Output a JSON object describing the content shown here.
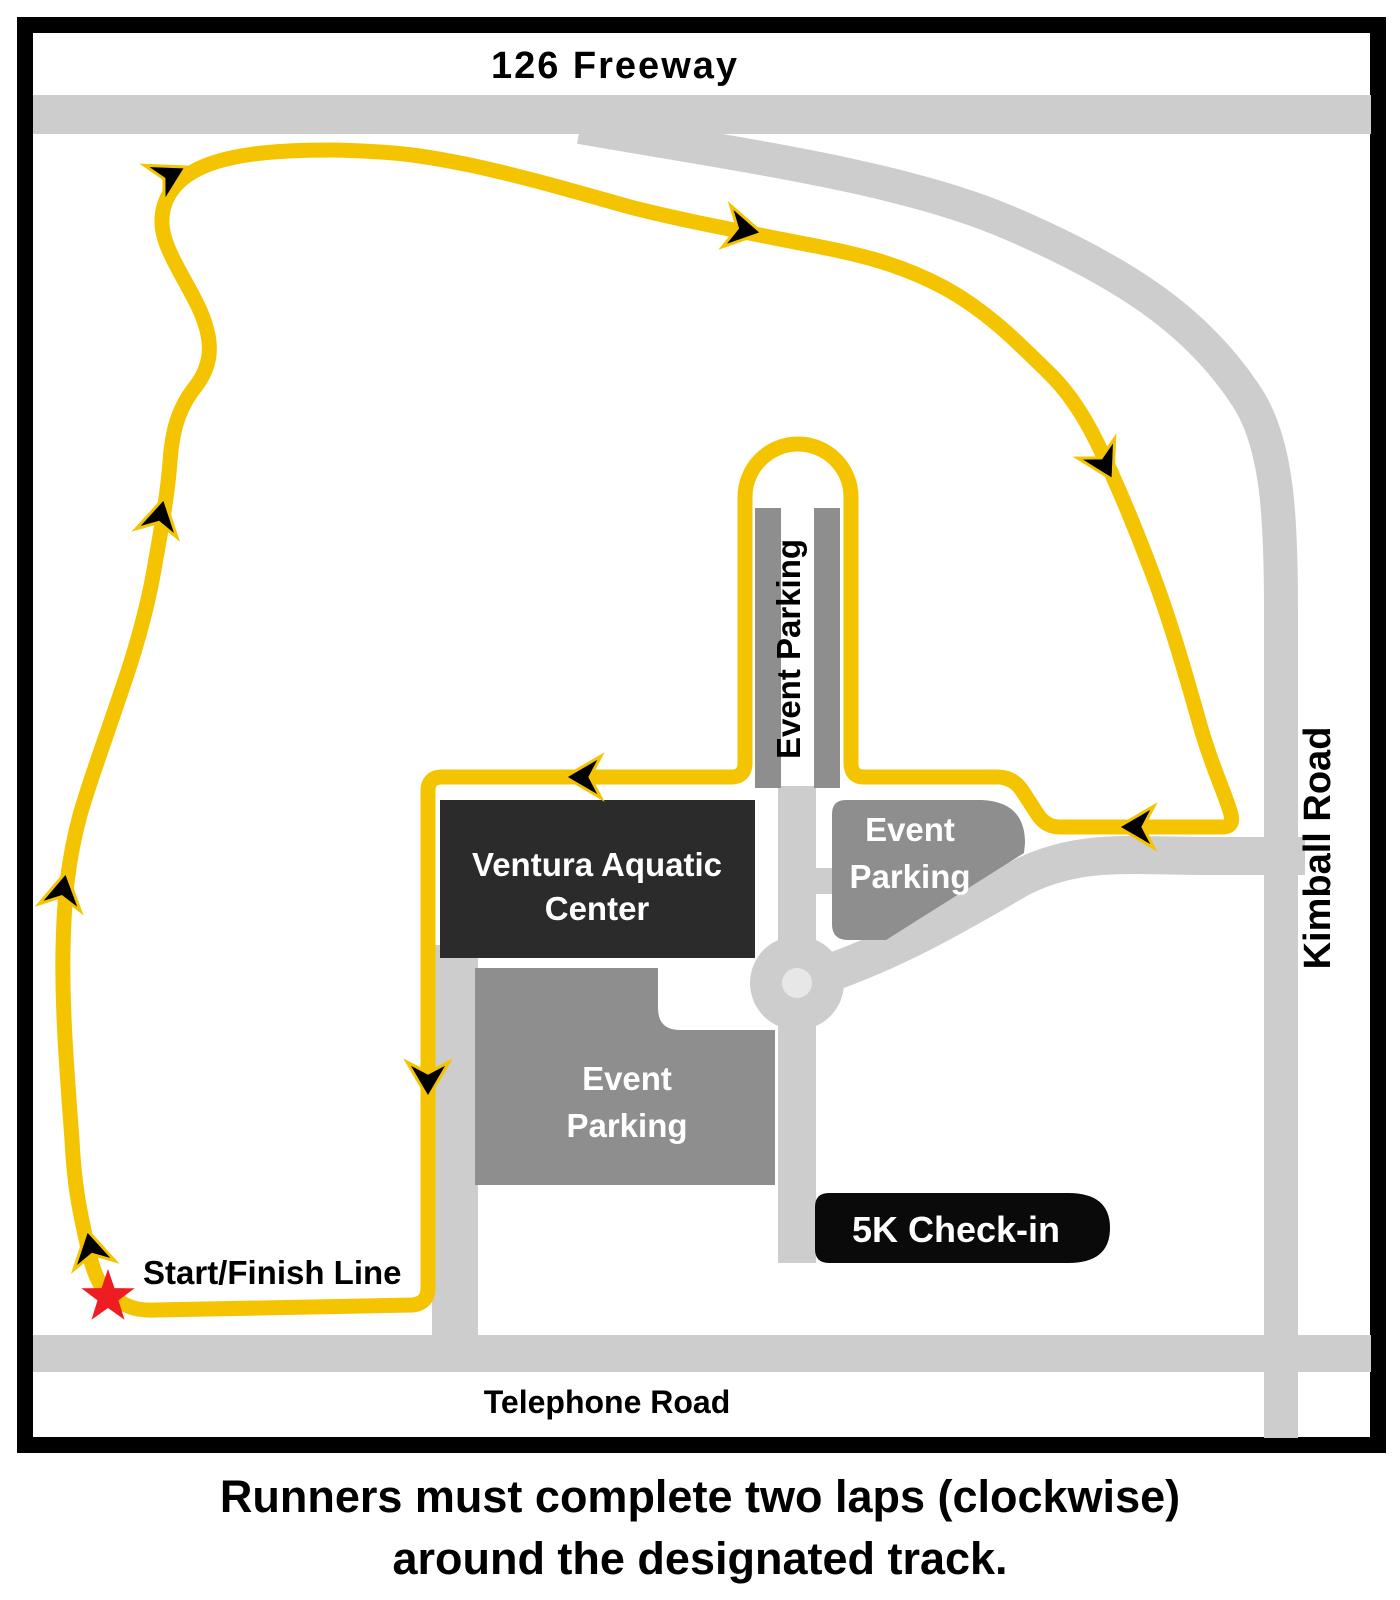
{
  "roads": {
    "freeway_label": "126 Freeway",
    "kimball_label": "Kimball Road",
    "telephone_label": "Telephone Road"
  },
  "course": {
    "start_finish_label": "Start/Finish Line"
  },
  "places": {
    "aquatic_center_line1": "Ventura Aquatic",
    "aquatic_center_line2": "Center",
    "parking_word1": "Event",
    "parking_word2": "Parking",
    "parking_vertical_label": "Event Parking",
    "checkin_label": "5K Check-in"
  },
  "caption": {
    "line1": "Runners must complete two laps (clockwise)",
    "line2": "around the designated track."
  },
  "colors": {
    "route": "#F5C400",
    "road": "#CDCDCD",
    "road_center": "#E7E7E7",
    "parking": "#8E8E8E",
    "building": "#2B2B2B",
    "checkin_bg": "#0A0A0A",
    "star": "#EE1C23"
  }
}
